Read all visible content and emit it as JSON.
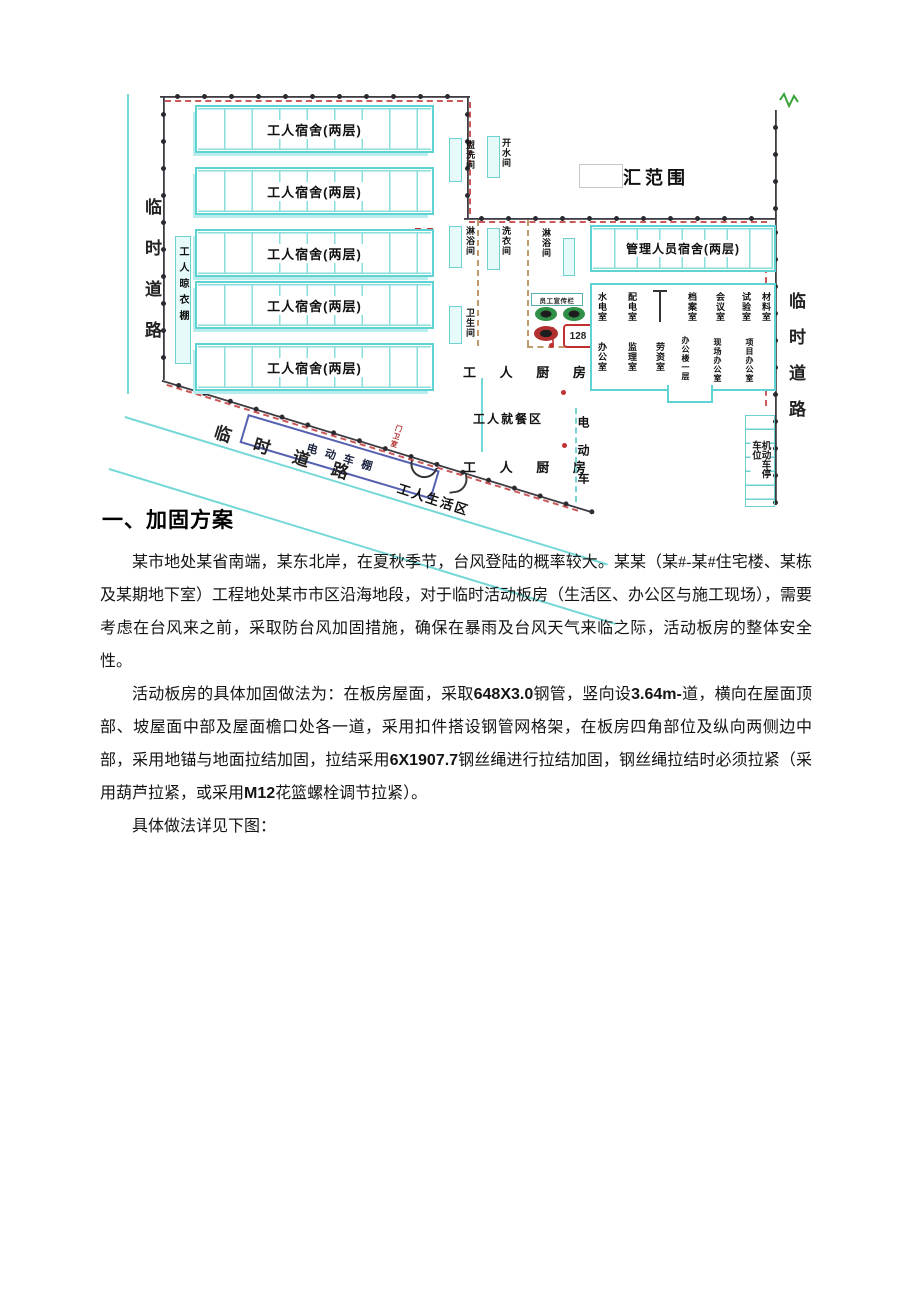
{
  "document": {
    "heading": "一、加固方案",
    "para1": "某市地处某省南端，某东北岸，在夏秋季节，台风登陆的概率较大。某某（某#-某#住宅楼、某栋及某期地下室）工程地处某市市区沿海地段，对于临时活动板房（生活区、办公区与施工现场），需要考虑在台风来之前，采取防台风加固措施，确保在暴雨及台风天气来临之际，活动板房的整体安全性。",
    "para2_segments": [
      "活动板房的具体加固做法为：在板房屋面，采取",
      "648X3.0",
      "钢管，竖向设",
      "3.64m-",
      "道，横向在屋面顶部、坡屋面中部及屋面檐口处各一道，采用扣件搭设钢管网格架，在板房四角部位及纵向两侧边中部，采用地锚与地面拉结加固，拉结采用",
      "6X1907.7",
      "钢丝绳进行拉结加固，钢丝绳拉结时必须拉紧（采用葫芦拉紧，或采用",
      "M12",
      "花篮螺栓调节拉紧）。"
    ],
    "para3": "具体做法详见下图："
  },
  "site_plan": {
    "road_label_left": "临时道路",
    "road_label_bottom": "临时道路",
    "road_label_right": "临时道路",
    "worker_dorm": "工人宿舍(两层)",
    "management_dorm": "管理人员宿舍(两层)",
    "clothes_shed": "工人晾衣棚",
    "boundary_note": "汇范围",
    "kitchen1": "工 人 厨 房",
    "dining": "工人就餐区",
    "kitchen2": "工 人 厨 房",
    "ev_shed": "电动车棚",
    "ev_area": "电动车",
    "parking": "机动车停车位",
    "gatehouse": "门卫室",
    "living_area": "工人生活区",
    "bulletin_board": "员工宣传栏",
    "sign_number": "128",
    "washrooms": [
      "盥洗间",
      "淋浴间",
      "卫生间",
      "开水间",
      "洗衣间",
      "淋浴间"
    ],
    "office_rooms_top": [
      "水电室",
      "配电室",
      "档案室",
      "会议室",
      "试验室",
      "材料室"
    ],
    "office_rooms_bottom": [
      "办公室",
      "监理室",
      "劳资室",
      "办公楼一层",
      "现场办公室",
      "项目办公室"
    ],
    "colors": {
      "building_outline": "#5fd3d3",
      "fence": "#3c3c42",
      "red_accent": "#c03030",
      "shed_blue": "#5561b0",
      "sign_green": "#2f8f46"
    }
  }
}
